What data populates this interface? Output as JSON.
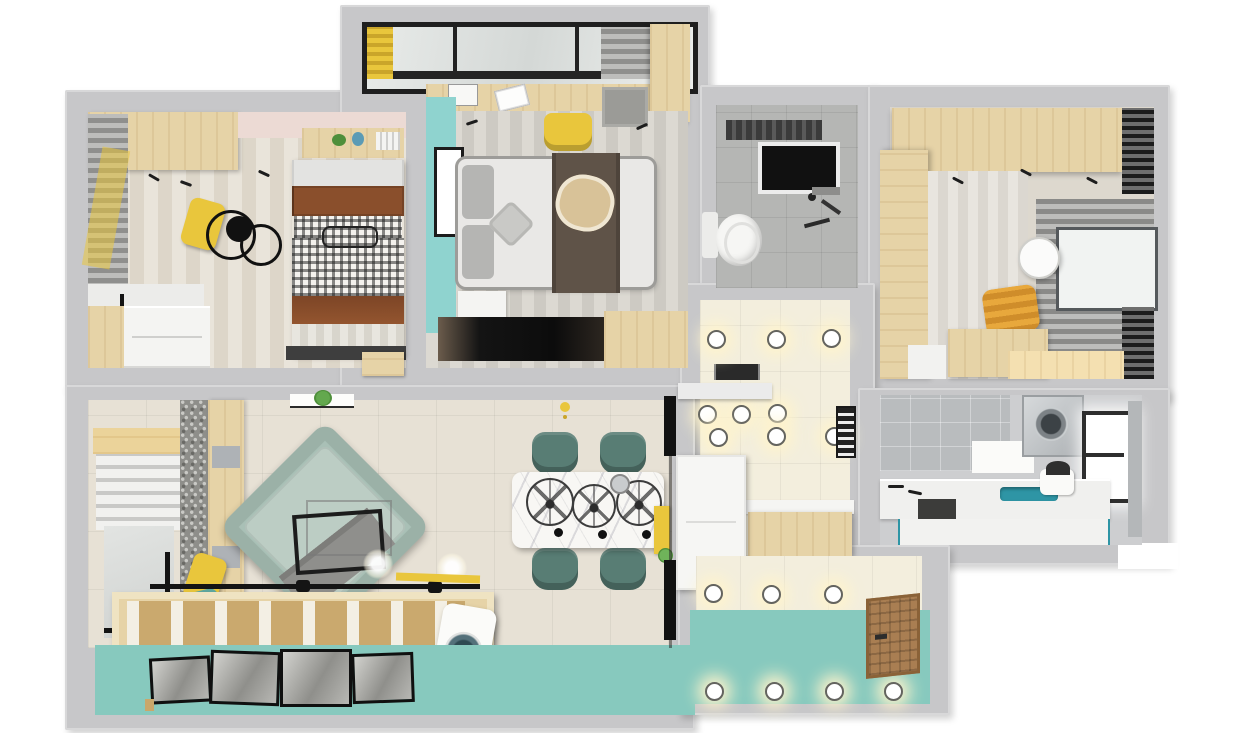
{
  "scene": {
    "kind": "3d-floor-plan-render",
    "view": "top-down isometric render of an apartment",
    "visible_text": "none",
    "width_px": 1254,
    "height_px": 733
  },
  "palette": {
    "bg": "#ffffff",
    "wall": "#c7c7c9",
    "dark": "#1d1d1d",
    "wood": "#e6d3a7",
    "wood_mid": "#d9bd85",
    "wood_dark": "#caa76a",
    "door_brown": "#a97e52",
    "yellow": "#e9c63c",
    "teal_wall": "#8fd3cf",
    "teal_floor": "#87c9be",
    "cream_tile": "#f3eedd",
    "light_glow": "#fff4cc",
    "gray_tile": "#b5b6b4",
    "laundry_floor": "#cdced0",
    "floor_beige": "#e7e1d5",
    "stripe_a": "#e9e4da",
    "stripe_b": "#ddd6c9",
    "mstripe_a": "#dcd9d2",
    "mstripe_b": "#cdcac3",
    "sofa": "#a9c0b6",
    "sofa_seat": "#bccdc4",
    "chair_green": "#587d74",
    "marble": "#f8f7f4",
    "bed_white": "#e9e8e6",
    "bed_gray": "#b5b5b3",
    "runner_brown": "#5f5348",
    "round_throw_tan": "#d8c298",
    "pillow_brown": "#8a4f2c",
    "pink_wall": "#ecdad4",
    "sage_pillow": "#cfd8ba",
    "teal_pillow": "#5fa8a0",
    "sink_teal": "#2e95a5",
    "plant_green": "#4e8f3a",
    "glass": "#e3e7e5"
  },
  "rooms": [
    {
      "id": "bedroom-2",
      "position": "top-left"
    },
    {
      "id": "master-bedroom",
      "position": "top-center"
    },
    {
      "id": "master-balcony",
      "position": "top-center-above"
    },
    {
      "id": "bathroom",
      "position": "center-top"
    },
    {
      "id": "study-bedroom",
      "position": "top-right"
    },
    {
      "id": "hallway",
      "position": "center"
    },
    {
      "id": "laundry-bathroom",
      "position": "right"
    },
    {
      "id": "living-room",
      "position": "bottom-left"
    },
    {
      "id": "dining-area",
      "position": "bottom-center"
    },
    {
      "id": "entry-hall",
      "position": "bottom-right"
    },
    {
      "id": "south-balcony",
      "position": "bottom"
    }
  ],
  "features": {
    "bedroom_2": [
      "wardrobe",
      "pink-accent-wall",
      "wall-shelf",
      "books",
      "plant",
      "blue-vase",
      "double-bed",
      "white-pillows",
      "brown-pillows",
      "plaid-cushions",
      "plaid-blanket",
      "brown-throw",
      "striped-duvet",
      "double-ring-ceiling-lamp",
      "gray-curtains",
      "window-seat",
      "yellow-cushion",
      "sage-cushion",
      "dresser",
      "desk-strip",
      "wood-stool"
    ],
    "master_bedroom": [
      "teal-accent-wall",
      "picture-frame",
      "double-bed",
      "gray-pillows",
      "star-pillow",
      "brown-bed-runner",
      "round-tan-throw",
      "nightstand",
      "tv-niche",
      "wood-tv-panel",
      "striped-floor",
      "gray-rug",
      "wardrobe-column",
      "desk-along-window",
      "open-book",
      "cat-picture",
      "yellow-chair"
    ],
    "master_balcony": [
      "full-width-window",
      "black-window-frame",
      "yellow-curtain",
      "gray-curtain"
    ],
    "bathroom": [
      "gray-floor-tiles",
      "exhaust-unit",
      "shower-screen",
      "toilet",
      "wall-fixtures"
    ],
    "study_bedroom": [
      "wardrobe-top",
      "wardrobe-left",
      "striped-wallpaper",
      "gray-curtain-wall",
      "window",
      "black-blinds",
      "round-mirror",
      "yellow-armchair",
      "desk",
      "side-desk"
    ],
    "hallway": [
      "cream-tile-floor",
      "recessed-ceiling-lights",
      "black-console",
      "vent-grille",
      "white-cabinet",
      "wood-sideboard",
      "wall-niche"
    ],
    "laundry_bathroom": [
      "gray-wall-tiles",
      "washing-machine",
      "window",
      "white-counter",
      "teal-sink",
      "faucet",
      "water-heater",
      "cabinet-fronts",
      "dark-niche"
    ],
    "living_room": [
      "wood-beam-band",
      "roman-blind",
      "balcony-glass-door",
      "black-door-frame",
      "speckled-wall-strip",
      "storage-shelf",
      "fabric-boxes",
      "yellow-cushion",
      "teal-cushion",
      "rotated-sofa",
      "gray-throw",
      "wire-coffee-table",
      "glass-side-table",
      "hanging-plant-shelf",
      "tile-floor",
      "floor-glow-lights",
      "slatted-daybed",
      "drying-rod",
      "yellow-level-tool",
      "portable-washer"
    ],
    "dining_area": [
      "marble-dining-table",
      "wire-pendant-lamps",
      "black-lamp-bulbs",
      "metal-kettle",
      "four-green-chairs",
      "yellow-sideboard",
      "potted-plant",
      "small-yellow-pendant",
      "black-glass-partition"
    ],
    "entry_hall": [
      "cream-tile-floor",
      "recessed-ceiling-lights",
      "wood-entry-door"
    ],
    "south_balcony": [
      "teal-floor",
      "framed-photos",
      "recessed-floor-lights"
    ]
  },
  "counts": {
    "dining_chairs": 4,
    "pendant_lamps": 3,
    "framed_photos_on_floor": 4,
    "hallway_lights": 9,
    "entry_lights": 3,
    "balcony_lights": 4
  }
}
